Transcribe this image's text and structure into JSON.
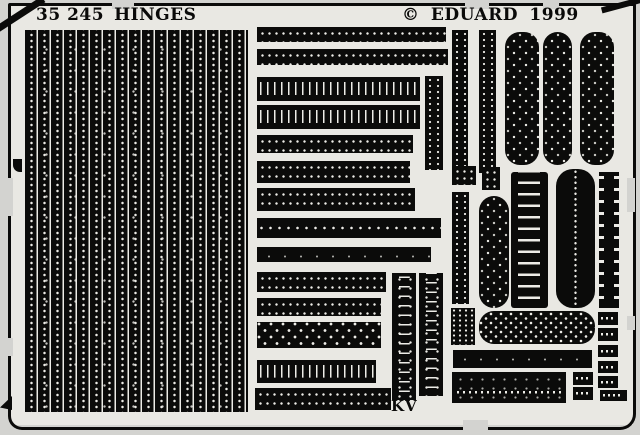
{
  "sheet": {
    "catalog_number": "35 245",
    "title": "HINGES",
    "copyright": "© EDUARD  1999",
    "mark": "KV",
    "colors": {
      "background": "#d3d3d0",
      "inner": "#e9e8e3",
      "metal": "#0b0b0a",
      "etch_detail": "#edece7"
    }
  },
  "parts": [
    {
      "type": "vblock",
      "x": 25,
      "y": 30,
      "w": 223,
      "h": 382
    },
    {
      "type": "dots2",
      "x": 257,
      "y": 27,
      "w": 189,
      "h": 15
    },
    {
      "type": "dots2",
      "x": 257,
      "y": 49,
      "w": 191,
      "h": 16
    },
    {
      "type": "vdash",
      "x": 257,
      "y": 77,
      "w": 163,
      "h": 24
    },
    {
      "type": "vdash",
      "x": 257,
      "y": 105,
      "w": 163,
      "h": 24
    },
    {
      "type": "dots2",
      "x": 257,
      "y": 135,
      "w": 156,
      "h": 18
    },
    {
      "type": "dots2",
      "x": 257,
      "y": 161,
      "w": 153,
      "h": 22
    },
    {
      "type": "vdots",
      "x": 425,
      "y": 76,
      "w": 18,
      "h": 94
    },
    {
      "type": "dots2",
      "x": 257,
      "y": 188,
      "w": 158,
      "h": 23
    },
    {
      "type": "dots1",
      "x": 257,
      "y": 218,
      "w": 184,
      "h": 20
    },
    {
      "type": "solid",
      "x": 257,
      "y": 247,
      "w": 174,
      "h": 15
    },
    {
      "type": "dots2",
      "x": 257,
      "y": 272,
      "w": 129,
      "h": 20
    },
    {
      "type": "dots2",
      "x": 257,
      "y": 298,
      "w": 124,
      "h": 18
    },
    {
      "type": "diamond",
      "x": 257,
      "y": 322,
      "w": 124,
      "h": 26
    },
    {
      "type": "vdash",
      "x": 257,
      "y": 360,
      "w": 119,
      "h": 23
    },
    {
      "type": "dots2",
      "x": 255,
      "y": 388,
      "w": 136,
      "h": 22
    },
    {
      "type": "vseg",
      "x": 392,
      "y": 273,
      "w": 24,
      "h": 127
    },
    {
      "type": "vseg",
      "x": 419,
      "y": 273,
      "w": 24,
      "h": 123
    },
    {
      "type": "vdots",
      "x": 452,
      "y": 30,
      "w": 16,
      "h": 143
    },
    {
      "type": "vdots",
      "x": 479,
      "y": 30,
      "w": 17,
      "h": 143
    },
    {
      "type": "pillv",
      "x": 505,
      "y": 32,
      "w": 34,
      "h": 133
    },
    {
      "type": "pillv",
      "x": 543,
      "y": 32,
      "w": 29,
      "h": 133
    },
    {
      "type": "pillv",
      "x": 580,
      "y": 32,
      "w": 34,
      "h": 133
    },
    {
      "type": "rects",
      "x": 452,
      "y": 166,
      "w": 24,
      "h": 19
    },
    {
      "type": "rects",
      "x": 482,
      "y": 167,
      "w": 18,
      "h": 23
    },
    {
      "type": "vdots",
      "x": 452,
      "y": 192,
      "w": 17,
      "h": 112
    },
    {
      "type": "vdots2",
      "x": 451,
      "y": 308,
      "w": 24,
      "h": 37
    },
    {
      "type": "pillv",
      "x": 479,
      "y": 196,
      "w": 30,
      "h": 112
    },
    {
      "type": "ladder",
      "x": 511,
      "y": 172,
      "w": 37,
      "h": 136
    },
    {
      "type": "pillvline",
      "x": 556,
      "y": 169,
      "w": 39,
      "h": 139
    },
    {
      "type": "notch",
      "x": 599,
      "y": 172,
      "w": 20,
      "h": 136
    },
    {
      "type": "pillh",
      "x": 479,
      "y": 311,
      "w": 116,
      "h": 33
    },
    {
      "type": "solid",
      "x": 453,
      "y": 350,
      "w": 139,
      "h": 18
    },
    {
      "type": "slab",
      "x": 452,
      "y": 372,
      "w": 114,
      "h": 31
    },
    {
      "type": "rectdash",
      "x": 573,
      "y": 372,
      "w": 20,
      "h": 13
    },
    {
      "type": "rectdash",
      "x": 573,
      "y": 387,
      "w": 20,
      "h": 13
    },
    {
      "type": "rectdash",
      "x": 598,
      "y": 312,
      "w": 20,
      "h": 13
    },
    {
      "type": "rectdash",
      "x": 598,
      "y": 328,
      "w": 20,
      "h": 13
    },
    {
      "type": "rectdash",
      "x": 598,
      "y": 345,
      "w": 20,
      "h": 12
    },
    {
      "type": "rectdash",
      "x": 598,
      "y": 361,
      "w": 20,
      "h": 12
    },
    {
      "type": "rectdash",
      "x": 598,
      "y": 376,
      "w": 20,
      "h": 12
    },
    {
      "type": "rectdash",
      "x": 600,
      "y": 390,
      "w": 27,
      "h": 11
    }
  ]
}
